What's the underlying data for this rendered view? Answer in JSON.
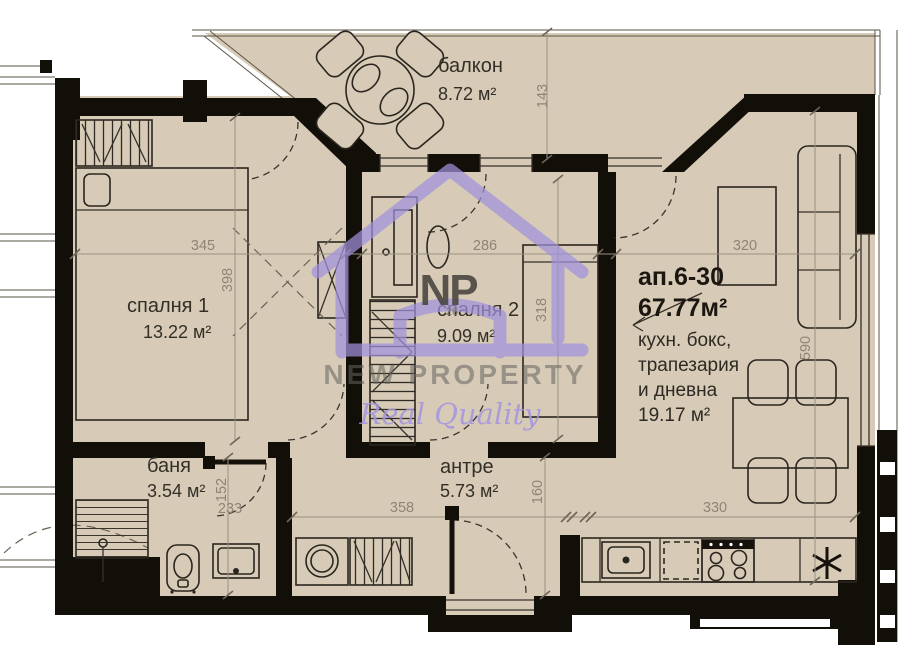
{
  "plan": {
    "apartment_label": "ап.6-30",
    "apartment_area": "67.77м²"
  },
  "rooms": {
    "balcony": {
      "name": "балкон",
      "area": "8.72 м²"
    },
    "bedroom1": {
      "name": "спалня 1",
      "area": "13.22 м²"
    },
    "bedroom2": {
      "name": "спалня 2",
      "area": "9.09 м²"
    },
    "living": {
      "name_line1": "кухн. бокс,",
      "name_line2": "трапезария",
      "name_line3": "и дневна",
      "area": "19.17 м²"
    },
    "bathroom": {
      "name": "баня",
      "area": "3.54 м²"
    },
    "hallway": {
      "name": "антре",
      "area": "5.73 м²"
    }
  },
  "dimensions": {
    "balcony_depth": "143",
    "bedroom1_width": "345",
    "bedroom1_depth": "398",
    "bedroom2_width": "286",
    "bedroom2_bed_depth": "318",
    "living_upper_width": "320",
    "living_depth": "590",
    "kitchen_width": "330",
    "bathroom_width": "233",
    "bathroom_depth": "152",
    "hallway_width": "358",
    "hallway_depth": "160"
  },
  "watermark": {
    "monogram": "NP",
    "monogram_number": "26",
    "brand": "NEW PROPERTY",
    "tagline": "Real Quality"
  },
  "colors": {
    "floor": "#d7cbb7",
    "wall": "#120e08",
    "dimension_text": "#8f8575",
    "label_text": "#332f27",
    "watermark_purple": "#a091dc",
    "watermark_gray": "#66655f"
  }
}
